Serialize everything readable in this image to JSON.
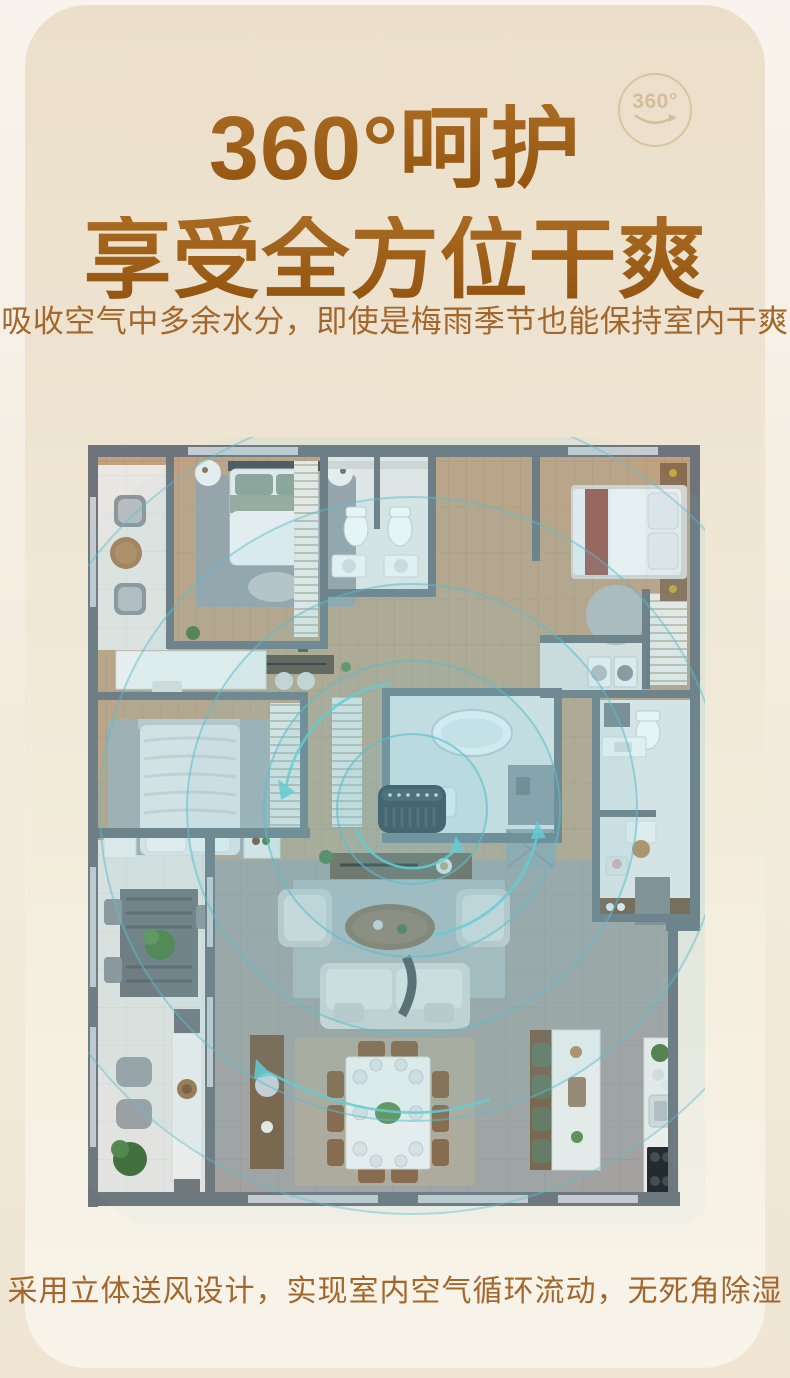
{
  "header": {
    "badge_label": "360°",
    "title_line1": "360°呵护",
    "title_line2": "享受全方位干爽",
    "subtitle": "吸收空气中多余水分，即使是梅雨季节也能保持室内干爽"
  },
  "footer": {
    "caption": "采用立体送风设计，实现室内空气循环流动，无死角除湿"
  },
  "colors": {
    "page_bg": "#f3ebdd",
    "card_top": "#ebdfca",
    "card_bottom": "#f9f4ea",
    "title_brown_dark": "#92540f",
    "title_brown_light": "#a96a22",
    "body_text_brown": "#a2672c",
    "badge_tan": "#d5bd99",
    "floorplan_wall": "#6d747b",
    "floorplan_wood": "#c2a17f",
    "floorplan_tile_gray": "#a5a19d",
    "ripple_teal": "#6fc6d4",
    "device_black": "#22262a"
  }
}
